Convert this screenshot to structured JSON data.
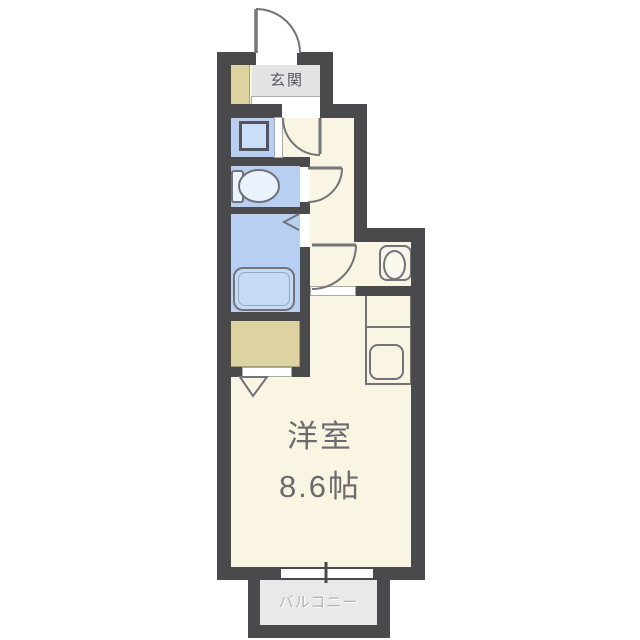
{
  "floorplan": {
    "rooms": {
      "entrance": {
        "label": "玄関"
      },
      "main_room": {
        "name": "洋室",
        "size": "8.6帖"
      },
      "balcony": {
        "label": "バルコニー"
      }
    },
    "fixtures": [
      "entrance-door",
      "shoe-cabinet",
      "washing-machine-pan",
      "toilet",
      "bathtub",
      "bathroom-door",
      "washbasin",
      "kitchen-counter",
      "stove-sink",
      "closet",
      "closet-folding-door",
      "interior-doors",
      "balcony-window"
    ],
    "colors": {
      "wall": "#4a4a4d",
      "floor": "#faf4e3",
      "wet_area_blue": "#b7d0f2",
      "storage_tan": "#ddd3a0",
      "entrance_gray": "#e3e3e3",
      "balcony_gray": "#e9e9e9",
      "fixture_outline": "#73737a",
      "room_text": "#6b6b6e",
      "balcony_text": "#b2b2b2"
    }
  }
}
